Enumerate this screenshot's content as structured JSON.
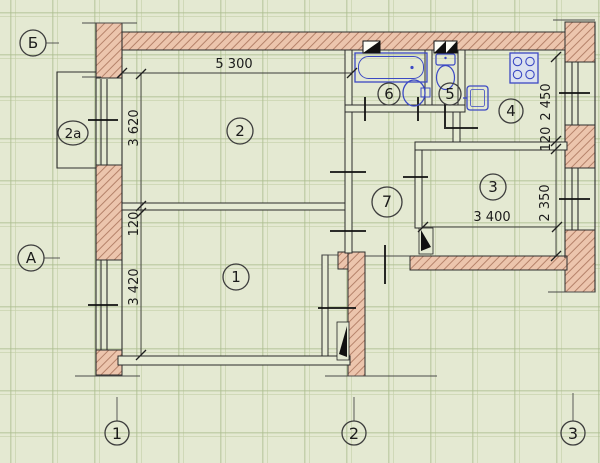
{
  "plan": {
    "room_labels": {
      "room1": "1",
      "room2": "2",
      "room2a": "2a",
      "room3": "3",
      "room4": "4",
      "room5": "5",
      "room6": "6",
      "room7": "7"
    },
    "axis_labels": {
      "top_row": "Б",
      "bottom_row": "А",
      "col1": "1",
      "col2": "2",
      "col3": "3"
    },
    "dimensions": {
      "top_width": "5 300",
      "left_upper": "3 620",
      "left_wall": "120",
      "left_lower": "3 420",
      "right_upper": "2 450",
      "right_wall": "120",
      "right_lower": "2 350",
      "room3_width": "3 400"
    },
    "colors": {
      "background": "#e4e9d2",
      "grid_line": "#c2cfa6",
      "wall_fill": "#ecc5ad",
      "wall_hatch": "#b5826a",
      "outline": "#2e2e2e",
      "fixture_blue": "#3c49c4"
    },
    "icons": {
      "bathtub": "bathtub-icon",
      "washbasin": "washbasin-icon",
      "toilet": "toilet-icon",
      "kitchen_sink": "kitchen-sink-icon",
      "stove": "stove-icon",
      "vent": "vent-shaft-icon",
      "door": "door-leaf-icon"
    }
  }
}
